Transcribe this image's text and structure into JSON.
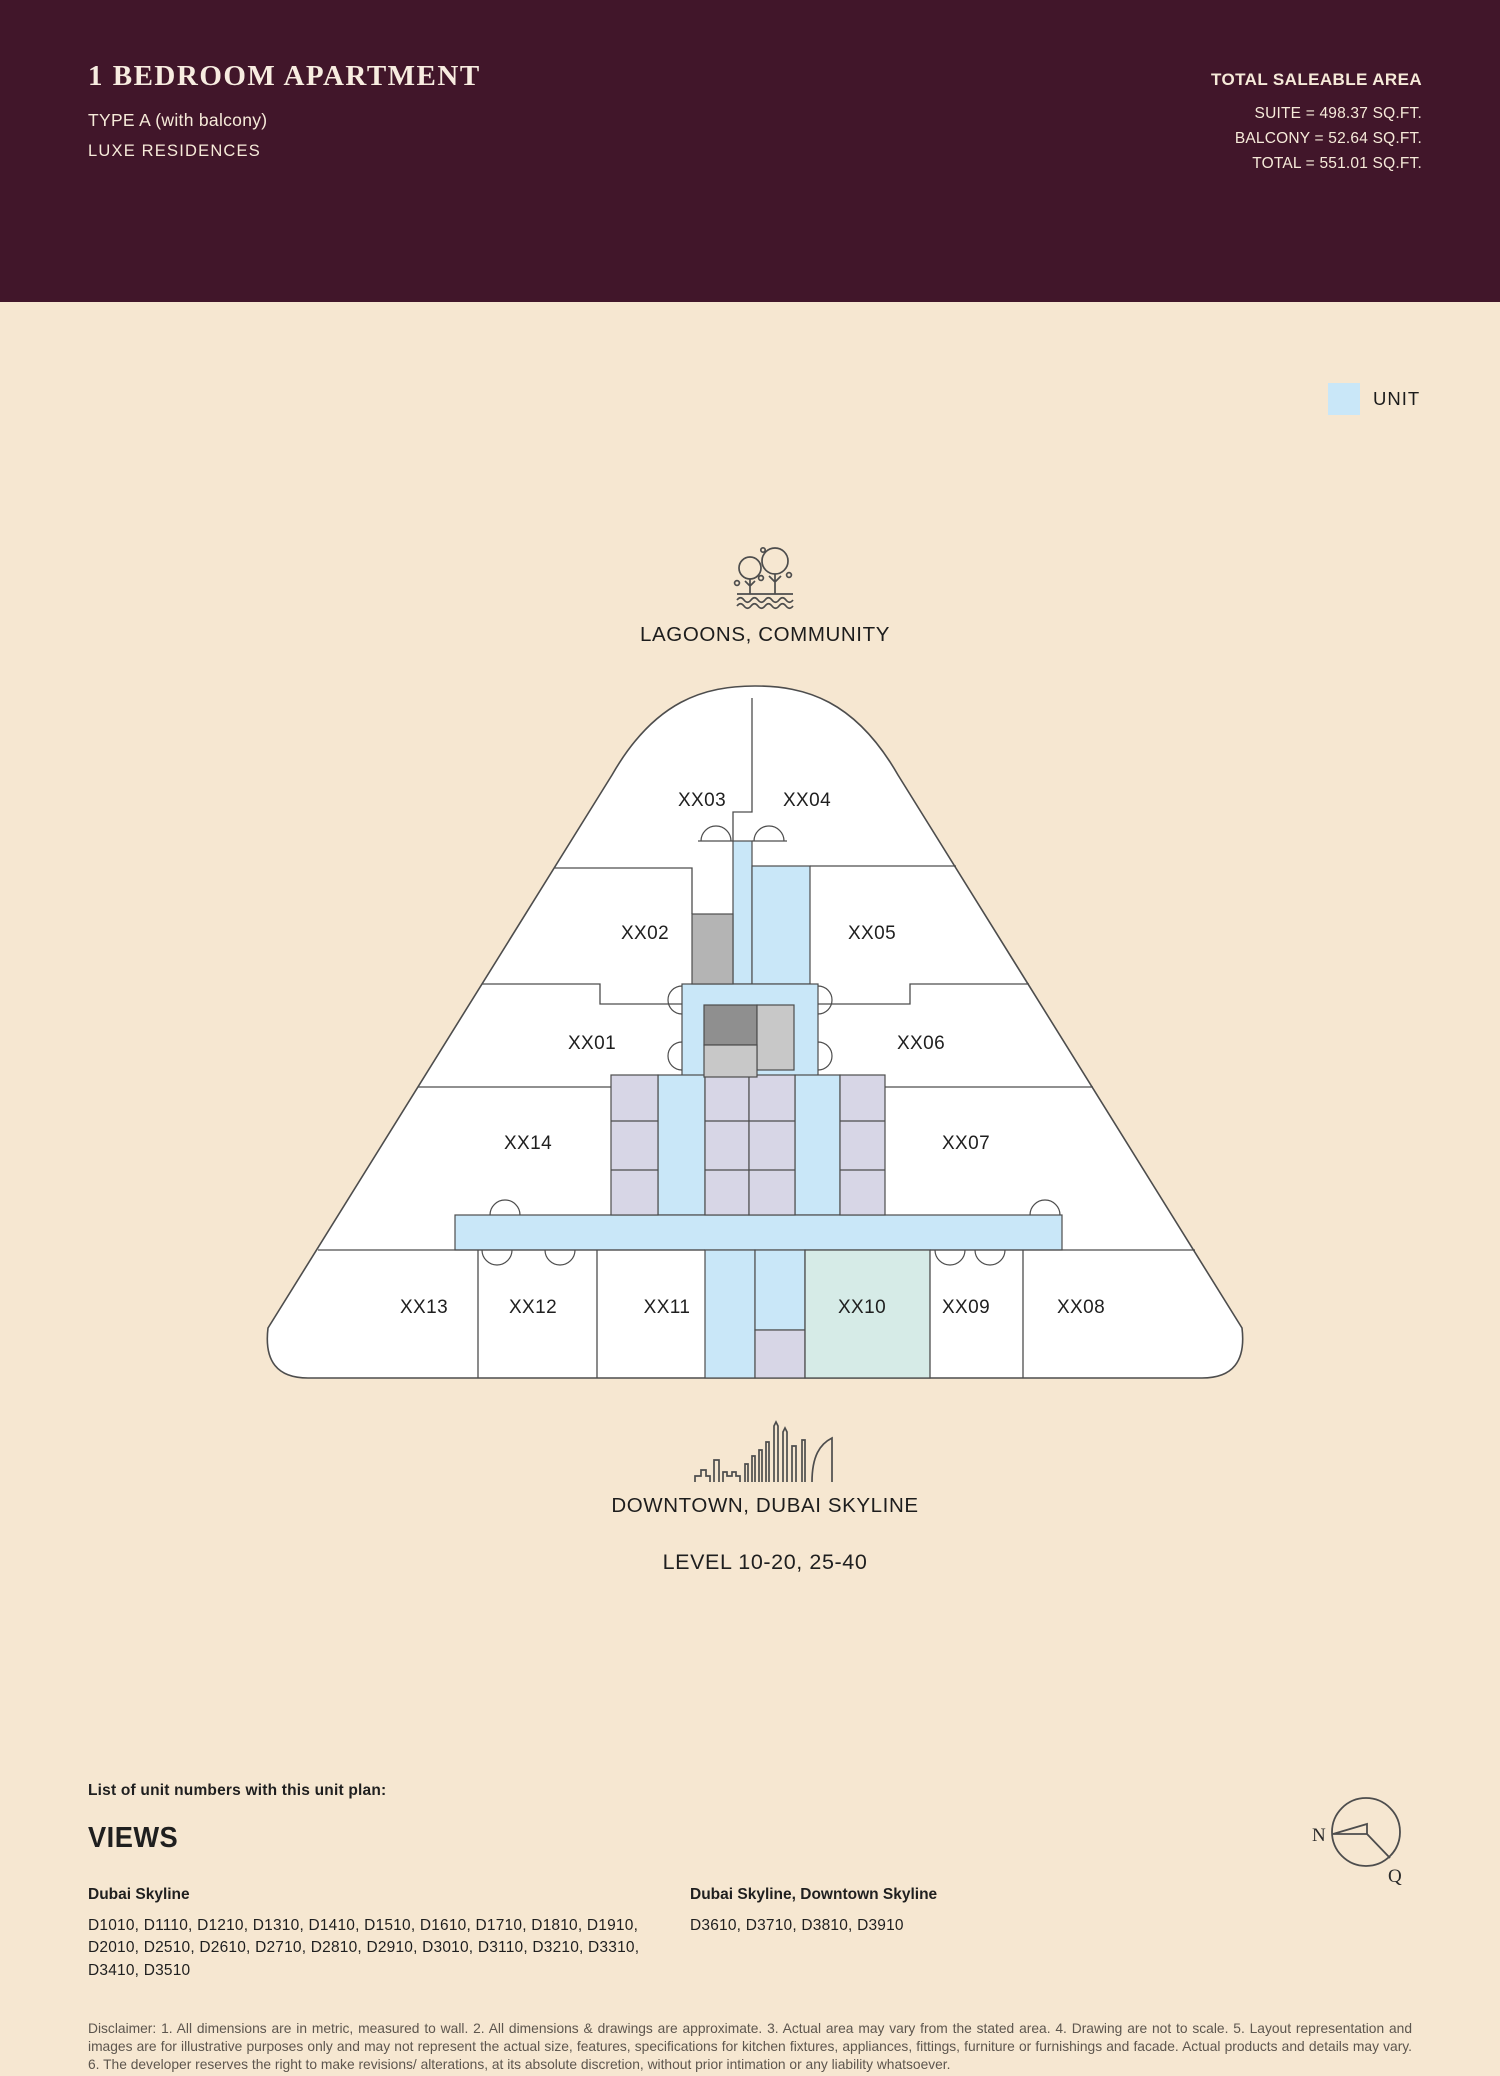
{
  "header": {
    "title": "1 BEDROOM APARTMENT",
    "type_line": "TYPE A (with balcony)",
    "brand": "LUXE RESIDENCES",
    "saleable_area": {
      "heading": "TOTAL SALEABLE AREA",
      "suite": "SUITE = 498.37 SQ.FT.",
      "balcony": "BALCONY = 52.64 SQ.FT.",
      "total": "TOTAL = 551.01 SQ.FT."
    }
  },
  "legend": {
    "unit_label": "UNIT",
    "unit_color": "#c9e7f8"
  },
  "plan": {
    "top_view_label": "LAGOONS, COMMUNITY",
    "bottom_view_label": "DOWNTOWN, DUBAI SKYLINE",
    "level_label": "LEVEL 10-20, 25-40",
    "highlighted_unit": "XX10",
    "units": {
      "xx01": "XX01",
      "xx02": "XX02",
      "xx03": "XX03",
      "xx04": "XX04",
      "xx05": "XX05",
      "xx06": "XX06",
      "xx07": "XX07",
      "xx08": "XX08",
      "xx09": "XX09",
      "xx10": "XX10",
      "xx11": "XX11",
      "xx12": "XX12",
      "xx13": "XX13",
      "xx14": "XX14"
    },
    "colors": {
      "header_maroon": "#41162a",
      "page_cream": "#f6e7d1",
      "corridor_blue": "#c9e7f8",
      "core_lavender": "#d7d6e6",
      "highlight_teal": "#d6ebe7",
      "gray_dark": "#8f8f8f",
      "gray_mid": "#b4b4b4",
      "gray_light": "#c8c8c8"
    }
  },
  "footer": {
    "list_heading": "List of unit numbers with this unit plan:",
    "views_heading": "VIEWS",
    "columns": [
      {
        "title": "Dubai Skyline",
        "units": "D1010, D1110, D1210, D1310, D1410, D1510, D1610, D1710, D1810, D1910, D2010, D2510, D2610, D2710, D2810, D2910, D3010, D3110, D3210, D3310, D3410, D3510"
      },
      {
        "title": "Dubai Skyline, Downtown Skyline",
        "units": "D3610, D3710, D3810, D3910"
      }
    ],
    "compass": {
      "north": "N",
      "q": "Q"
    },
    "disclaimer": "Disclaimer: 1. All dimensions are in metric, measured to wall. 2. All dimensions & drawings are approximate. 3. Actual area may vary from the stated area. 4. Drawing are not to scale. 5. Layout representation and images are for illustrative purposes only and may not represent the actual size, features, specifications for kitchen fixtures, appliances, fittings, furniture or furnishings and facade. Actual products and details may vary. 6. The developer reserves the right to make revisions/ alterations, at its absolute discretion, without prior intimation or any liability whatsoever."
  }
}
